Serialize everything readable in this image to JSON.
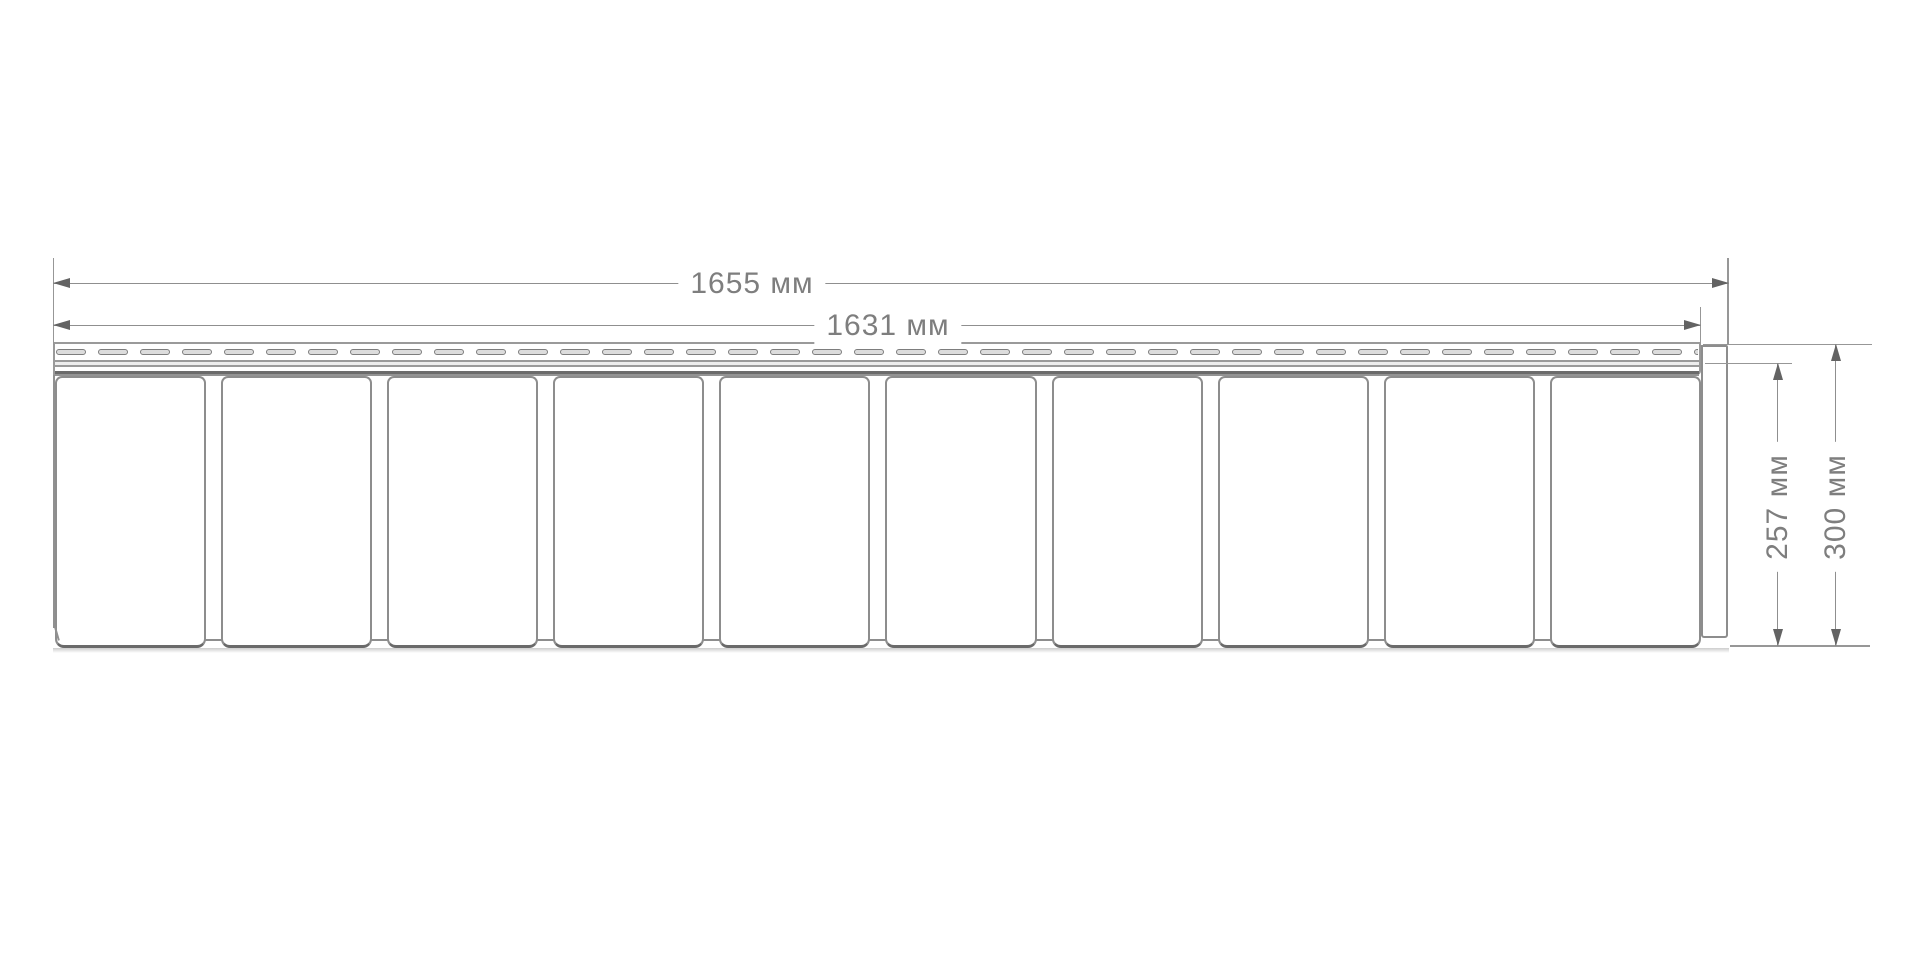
{
  "diagram": {
    "type": "technical-dimension-drawing",
    "subject": "siding-panel-profile-front-view",
    "panels_count": 10,
    "nail_slots_count": 40,
    "dimensions": {
      "overall_width": "1655 мм",
      "panel_width": "1631 мм",
      "panel_height": "257 мм",
      "overall_height": "300 мм"
    },
    "colors": {
      "background": "#ffffff",
      "outline": "#8d8d8d",
      "outline_dark": "#6a6a6a",
      "dimension_line": "#8f8f8f",
      "arrowhead": "#636363",
      "label_text": "#7e7e7e",
      "slot_fill": "#dcdcdc"
    }
  }
}
